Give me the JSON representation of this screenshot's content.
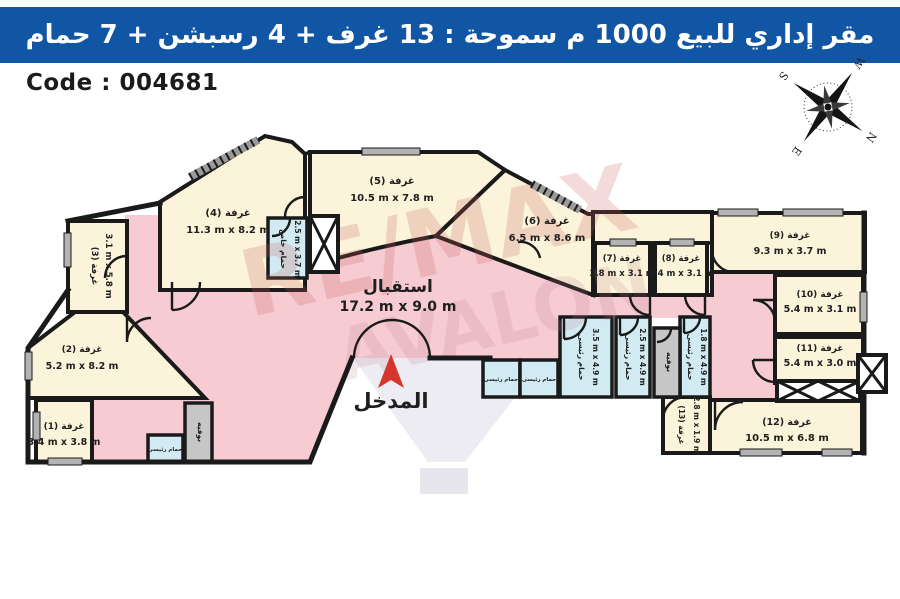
{
  "header": {
    "title": "مقر إداري للبيع 1000 م سموحة :  13 غرف + 4 رسبشن + 7 حمام"
  },
  "code": {
    "label": "Code : 004681"
  },
  "compass": {
    "n": "N",
    "s": "S",
    "e": "E",
    "w": "W"
  },
  "watermark": {
    "line1": "RE/MAX",
    "line2": "AVALON"
  },
  "colors": {
    "header_bg": "#1156A4",
    "room_cream": "#FBF3DA",
    "hall_pink": "#F6CBD2",
    "bath_cyan": "#D2EBF2",
    "buffet_gray": "#C6C6C6",
    "wall": "#1A1A1A",
    "entrance_red": "#D6352B"
  },
  "plan": {
    "reception": {
      "name": "استقبال",
      "dims": "17.2 m x 9.0 m"
    },
    "entrance": {
      "name": "المدخل"
    },
    "rooms": [
      {
        "name": "غرفة (1)",
        "dims": "3.4 m x 3.8 m"
      },
      {
        "name": "غرفة (2)",
        "dims": "5.2 m x 8.2 m"
      },
      {
        "name": "غرفة (3)",
        "dims": "3.1 m x 5.8 m"
      },
      {
        "name": "غرفة (4)",
        "dims": "11.3 m x 8.2 m"
      },
      {
        "name": "غرفة (5)",
        "dims": "10.5 m x 7.8 m"
      },
      {
        "name": "غرفة (6)",
        "dims": "6.5 m x 8.6 m"
      },
      {
        "name": "غرفة (7)",
        "dims": "3.8 m x 3.1 m"
      },
      {
        "name": "غرفة (8)",
        "dims": "3.4 m x 3.1 m"
      },
      {
        "name": "غرفة (9)",
        "dims": "9.3 m x 3.7 m"
      },
      {
        "name": "غرفة (10)",
        "dims": "5.4 m x 3.1 m"
      },
      {
        "name": "غرفة (11)",
        "dims": "5.4 m x 3.0 m"
      },
      {
        "name": "غرفة (12)",
        "dims": "10.5 m x 6.8 m"
      },
      {
        "name": "غرفة (13)",
        "dims": "2.8 m x 1.9 m"
      }
    ],
    "baths": {
      "private": {
        "name": "حمام خاص",
        "dims": "2.5 m x 3.7 m"
      },
      "main1": {
        "name": "حمام رئيسى",
        "dims": "3.5 m x 4.9 m"
      },
      "main2": {
        "name": "حمام رئيسى",
        "dims": "2.5 m x 4.9 m"
      },
      "main3": {
        "name": "حمام رئيسى",
        "dims": "1.8 m x 4.9 m"
      },
      "small_west": {
        "name": "حمام رئيسى"
      },
      "pair_a": {
        "name": "حمام رئيسى"
      },
      "pair_b": {
        "name": "حمام رئيسى"
      }
    },
    "buffets": {
      "west": "بوفيه",
      "east": "بوفيه"
    }
  }
}
